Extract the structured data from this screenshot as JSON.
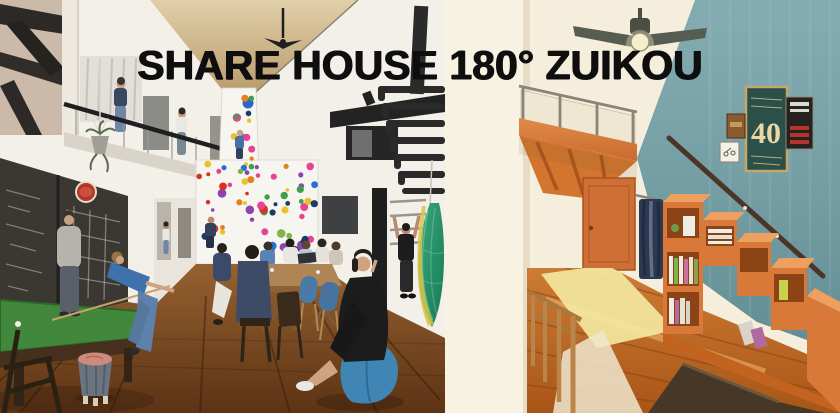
{
  "title": "SHARE HOUSE 180° ZUIKOU",
  "right_room": {
    "poster_text": "40"
  },
  "colors": {
    "title_text": "#0e0e0e",
    "teal_wall": "#72a0a6",
    "accent_orange": "#d8793a",
    "pool_table_felt": "#42883c",
    "left_floor_wood": "#7c4a24",
    "right_floor_wood": "#c9762f",
    "climbing_wall": "#f7f5f0",
    "chalkboard": "#3b3834",
    "hold_palette": [
      "#d93025",
      "#2b6fd4",
      "#e8c12b",
      "#3d9e4d",
      "#e67e22",
      "#e84393",
      "#1b3a6b",
      "#7ab648",
      "#8e44ad"
    ]
  },
  "climbing_holds": {
    "column_count": 16,
    "panel_count": 64
  }
}
